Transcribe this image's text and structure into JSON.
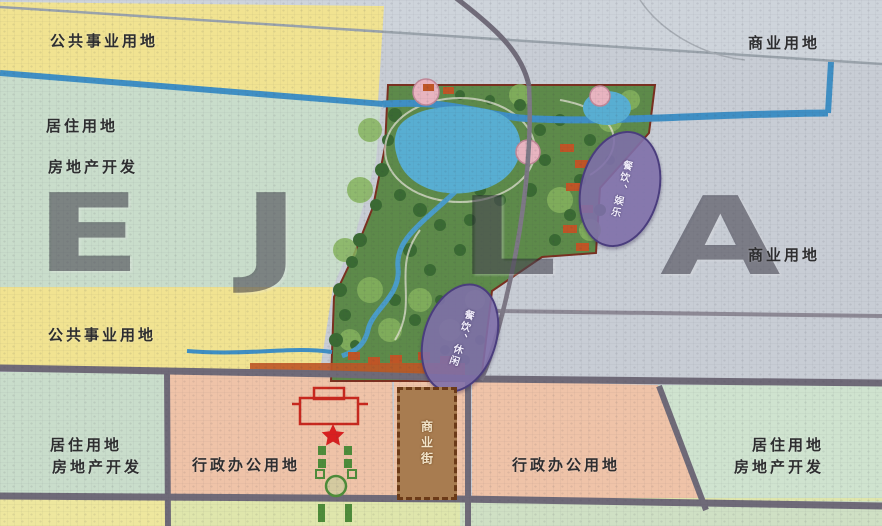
{
  "map": {
    "type": "land-use-planning-map",
    "watermark": {
      "text": "EJLA",
      "letters": [
        "E",
        "J",
        "L",
        "A"
      ]
    },
    "zones": [
      {
        "id": "public-utility-top-left",
        "text": "公共事业用地"
      },
      {
        "id": "commercial-top-right",
        "text": "商业用地"
      },
      {
        "id": "residential-left-line1",
        "text": "居住用地"
      },
      {
        "id": "residential-left-line2",
        "text": "房地产开发"
      },
      {
        "id": "commercial-mid-right",
        "text": "商业用地"
      },
      {
        "id": "public-utility-mid-left",
        "text": "公共事业用地"
      },
      {
        "id": "residential-bottom-left-line1",
        "text": "居住用地"
      },
      {
        "id": "residential-bottom-left-line2",
        "text": "房地产开发"
      },
      {
        "id": "admin-office-left",
        "text": "行政办公用地"
      },
      {
        "id": "admin-office-right",
        "text": "行政办公用地"
      },
      {
        "id": "residential-bottom-right-line1",
        "text": "居住用地"
      },
      {
        "id": "residential-bottom-right-line2",
        "text": "房地产开发"
      }
    ],
    "callouts": {
      "north_ellipse": "餐饮、娱乐",
      "south_ellipse": "餐饮、休闲",
      "commercial_street": "商业街"
    },
    "colors": {
      "public_utility_yellow": "#f1e391",
      "residential_green": "#c9ddcb",
      "commercial_gray": "#c8cdd5",
      "admin_office_pink": "#efc3a8",
      "park_green": "#5d8a4a",
      "water_blue": "#58aed2",
      "river_blue": "#3f8fc4",
      "road_gray": "#6f6a78",
      "callout_purple": "#7e6fa8",
      "street_brown": "#a87c50",
      "landmark_red": "#c8281e"
    }
  }
}
